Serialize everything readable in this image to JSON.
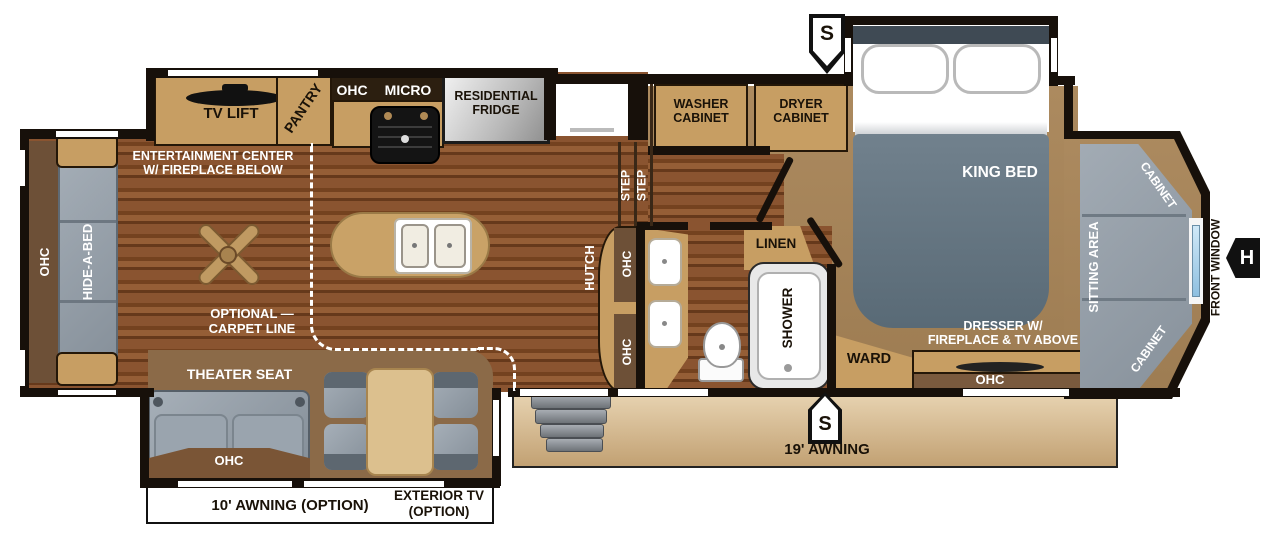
{
  "labels": {
    "tv_lift": "TV LIFT",
    "pantry": "PANTRY",
    "ohc": "OHC",
    "micro": "MICRO",
    "fridge": "RESIDENTIAL\nFRIDGE",
    "entertainment": "ENTERTAINMENT CENTER\nW/ FIREPLACE BELOW",
    "hide_a_bed": "HIDE-A-BED",
    "carpet_note": "OPTIONAL —\nCARPET LINE",
    "theater_seat": "THEATER SEAT",
    "step": "STEP",
    "hutch": "HUTCH",
    "linen": "LINEN",
    "shower": "SHOWER",
    "ward": "WARD",
    "washer": "WASHER\nCABINET",
    "dryer": "DRYER\nCABINET",
    "king_bed": "KING BED",
    "dresser": "DRESSER W/\nFIREPLACE & TV ABOVE",
    "sitting_area": "SITTING AREA",
    "cabinet": "CABINET",
    "front_window": "FRONT WINDOW",
    "awning19": "19' AWNING",
    "awning10": "10' AWNING (OPTION)",
    "exterior_tv": "EXTERIOR TV\n(OPTION)",
    "s_marker": "S",
    "h_marker": "H"
  },
  "colors": {
    "wall": "#17100a",
    "wood_floor": "#8a5430",
    "cabinet_tan": "#c79e63",
    "overhead_brown": "#6d5037",
    "seat_gray": "#97a1ab",
    "bed_gray": "#64747f",
    "bedroom_carpet": "#a5845a",
    "awning_beige": "#d8bf9e",
    "window_blue": "#9ec8e8"
  }
}
